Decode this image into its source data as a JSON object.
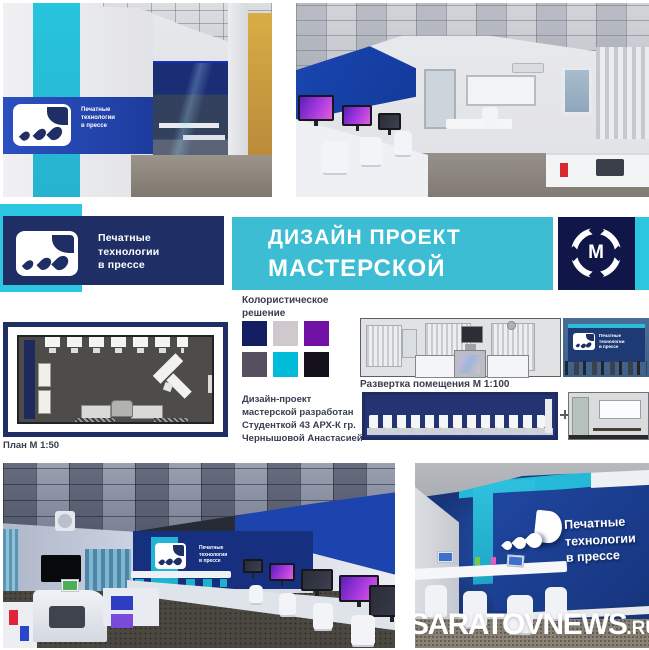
{
  "brand": {
    "name_lines": "Печатные\nтехнологии\nв прессе",
    "title_line1": "ДИЗАЙН ПРОЕКТ",
    "title_line2": "МАСТЕРСКОЙ",
    "emblem_letter": "М"
  },
  "palette": {
    "heading": "Колористическое\nрешение",
    "swatches": [
      "#141f63",
      "#cfc8cd",
      "#7211a5",
      "#564f5f",
      "#00bcd8",
      "#14111a"
    ]
  },
  "credit": "Дизайн-проект\nмастерской разработан\nСтуденткой 43 АРХ-К гр.\nЧернышовой Анастасией",
  "plan": {
    "label": "План М 1:50"
  },
  "elevations": {
    "label": "Развертка помещения М 1:100"
  },
  "watermark": {
    "main": "SARATOVNEWS",
    "suffix": ".RU"
  },
  "colors": {
    "navy_banner": "#1f2f66",
    "cyan_banner": "#3cbdd3",
    "emblem_navy": "#101748",
    "cyan_stripe": "#2bc6e0",
    "text_dark": "#363d4e",
    "royal_blue": "#1c43ae",
    "wall_navy": "#16307f"
  }
}
